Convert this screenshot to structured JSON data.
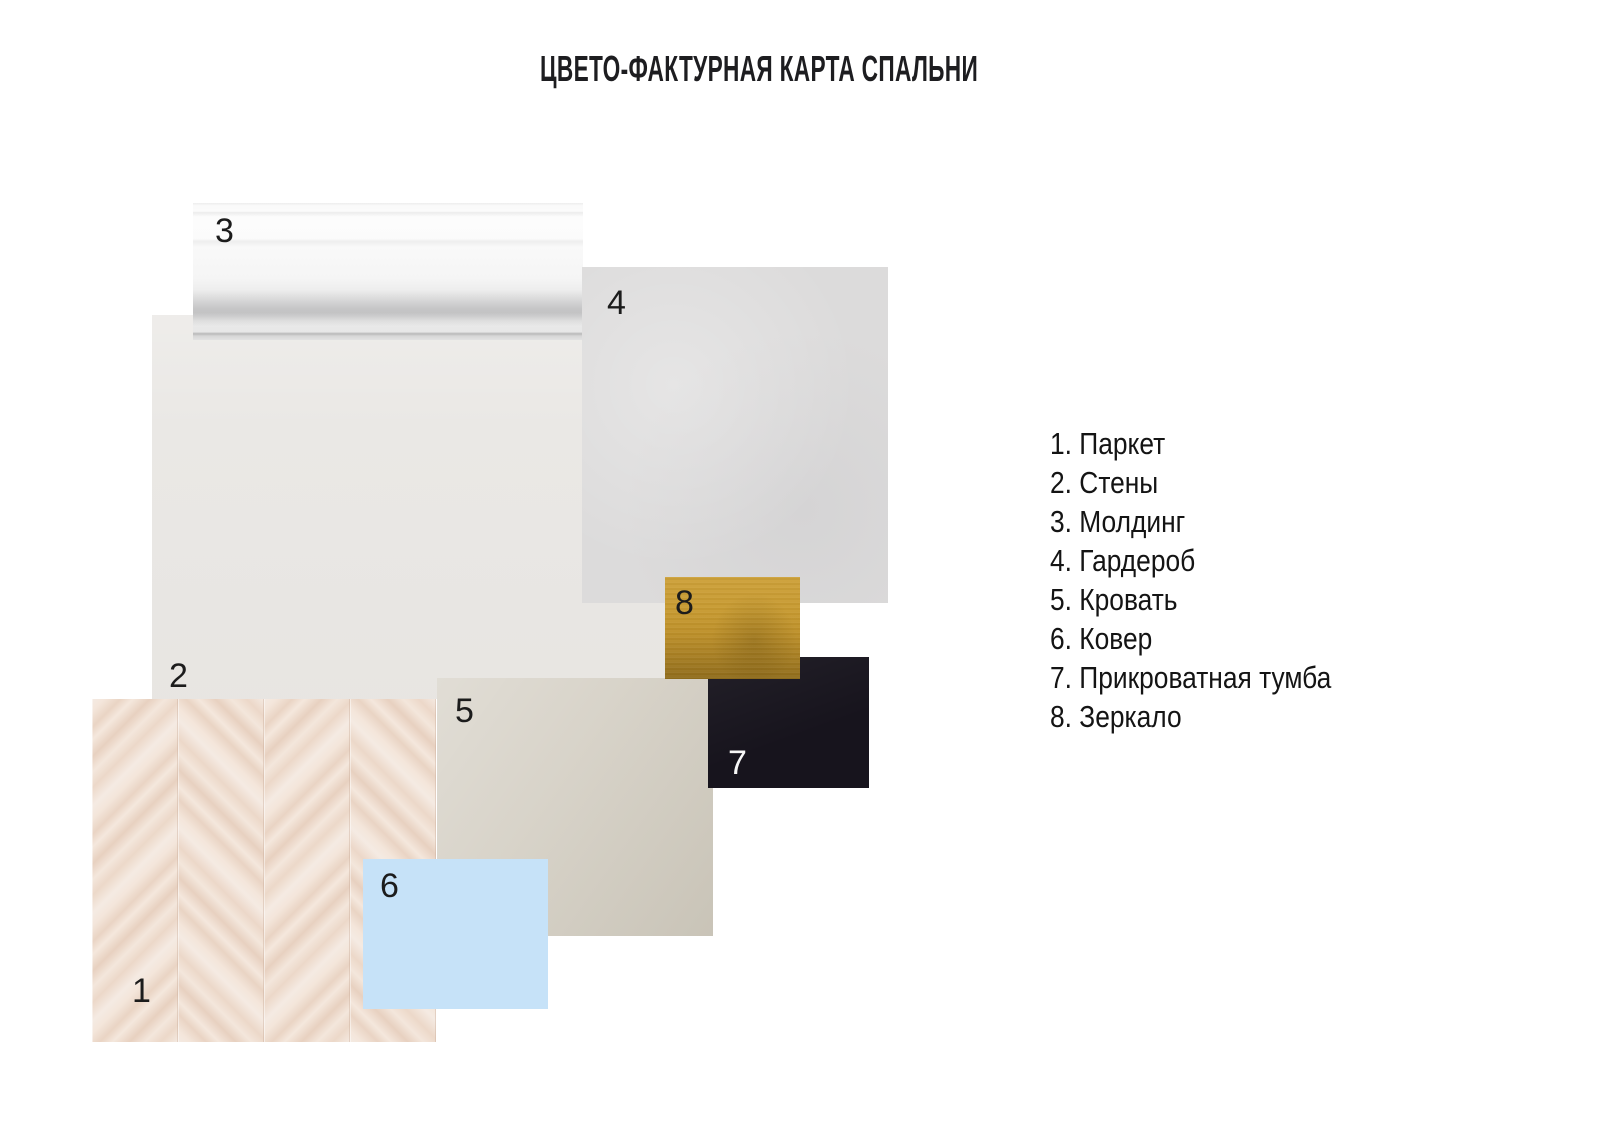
{
  "title": "ЦВЕТО-ФАКТУРНАЯ КАРТА СПАЛЬНИ",
  "legend": {
    "items": [
      {
        "text": "1. Паркет"
      },
      {
        "text": "2. Стены"
      },
      {
        "text": "3. Молдинг"
      },
      {
        "text": "4. Гардероб"
      },
      {
        "text": "5. Кровать"
      },
      {
        "text": "6. Ковер"
      },
      {
        "text": "7. Прикроватная тумба"
      },
      {
        "text": "8. Зеркало"
      }
    ]
  },
  "swatches": {
    "parquet": {
      "number": "1",
      "label": "Паркет",
      "color": "#eeddd0"
    },
    "walls": {
      "number": "2",
      "label": "Стены",
      "color": "#eae8e5"
    },
    "molding": {
      "number": "3",
      "label": "Молдинг",
      "color": "#f7f7f7"
    },
    "wardrobe": {
      "number": "4",
      "label": "Гардероб",
      "color": "#dcdbdb"
    },
    "bed": {
      "number": "5",
      "label": "Кровать",
      "color": "#d5d0c5"
    },
    "carpet": {
      "number": "6",
      "label": "Ковер",
      "color": "#c6e2f8"
    },
    "nightstand": {
      "number": "7",
      "label": "Прикроватная тумба",
      "color": "#17141d"
    },
    "mirror": {
      "number": "8",
      "label": "Зеркало",
      "color": "#c2932b"
    }
  },
  "page": {
    "background": "#ffffff",
    "text_color": "#1c1c1c"
  }
}
